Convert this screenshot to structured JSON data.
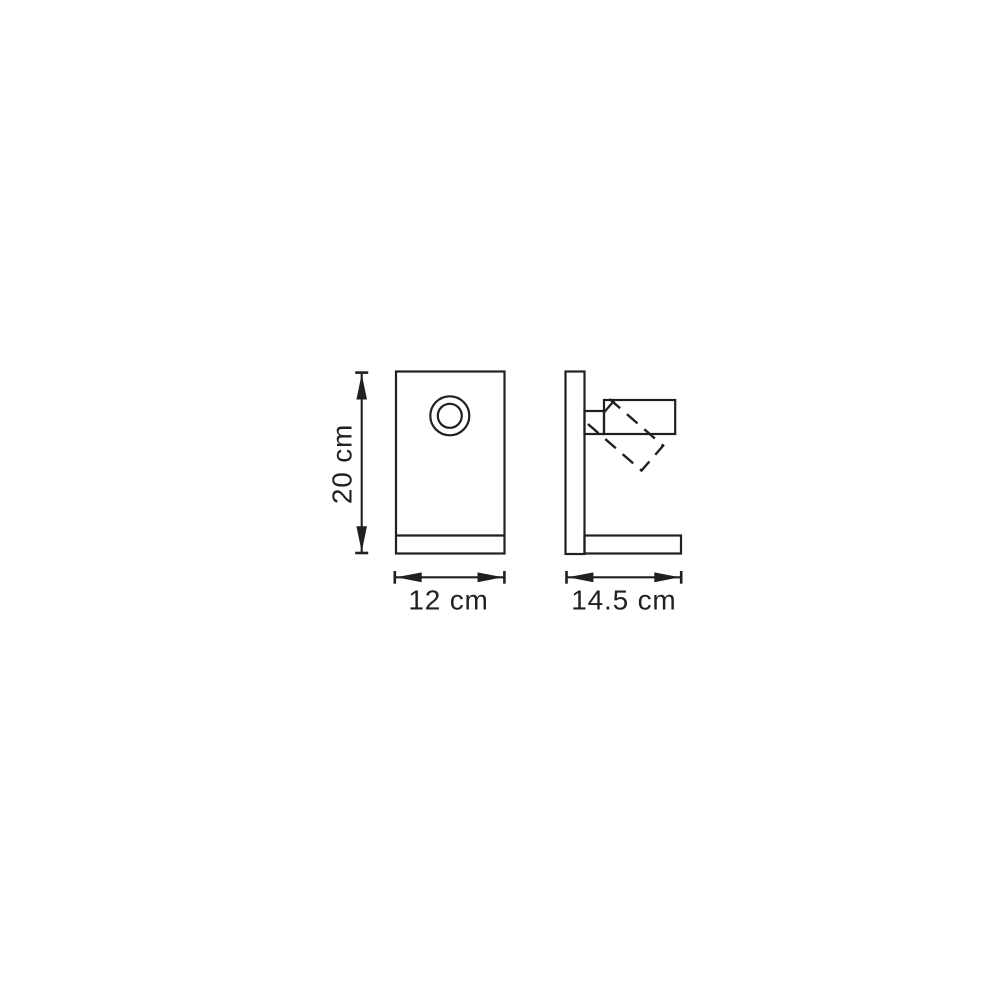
{
  "figure": {
    "background_color": "#ffffff",
    "line_color": "#231f20"
  },
  "dimensions": {
    "height": {
      "label": "20 cm",
      "value": 20,
      "unit": "cm"
    },
    "width": {
      "label": "12 cm",
      "value": 12,
      "unit": "cm"
    },
    "depth": {
      "label": "14.5 cm",
      "value": 14.5,
      "unit": "cm"
    }
  }
}
